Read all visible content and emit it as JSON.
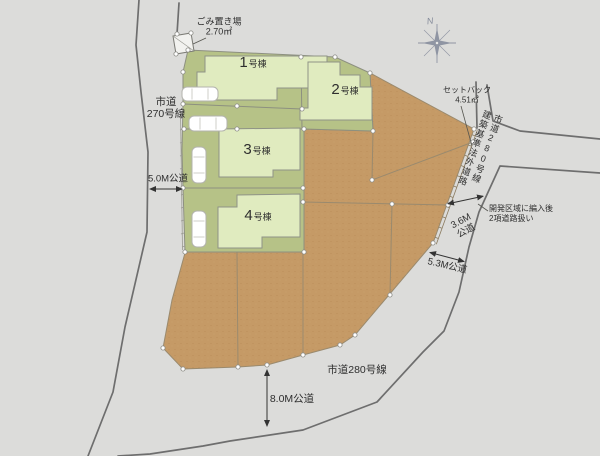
{
  "plan_title": "site-plan",
  "colors": {
    "background": "#dcdcda",
    "lot_green": "#b6c287",
    "building_fill": "#e0ebbf",
    "lot_brown": "#c59a66",
    "road_line": "#6e6e6e",
    "boundary_line": "#8d9080",
    "text": "#2e2e2e",
    "compass": "#8f95a3"
  },
  "compass": {
    "north_label": "N"
  },
  "garbage": {
    "title": "ごみ置き場",
    "area": "2.70㎡"
  },
  "setback": {
    "title": "セットバック",
    "area": "4.51㎡"
  },
  "dev_note": {
    "line1": "開発区域に編入後",
    "line2": "2項道路扱い"
  },
  "roads": {
    "west_name_line1": "市道",
    "west_name_line2": "270号線",
    "west_width": "5.0M公道",
    "east_name_col_right": "市道280号線",
    "east_name_col_left": "建築基準法外道路",
    "east_width_line1": "3.6M",
    "east_width_line2": "公道",
    "southeast_width": "5.3M公道",
    "south_name": "市道280号線",
    "south_width": "8.0M公道"
  },
  "lots": [
    {
      "num": "1",
      "suffix": "号棟"
    },
    {
      "num": "2",
      "suffix": "号棟"
    },
    {
      "num": "3",
      "suffix": "号棟"
    },
    {
      "num": "4",
      "suffix": "号棟"
    }
  ]
}
